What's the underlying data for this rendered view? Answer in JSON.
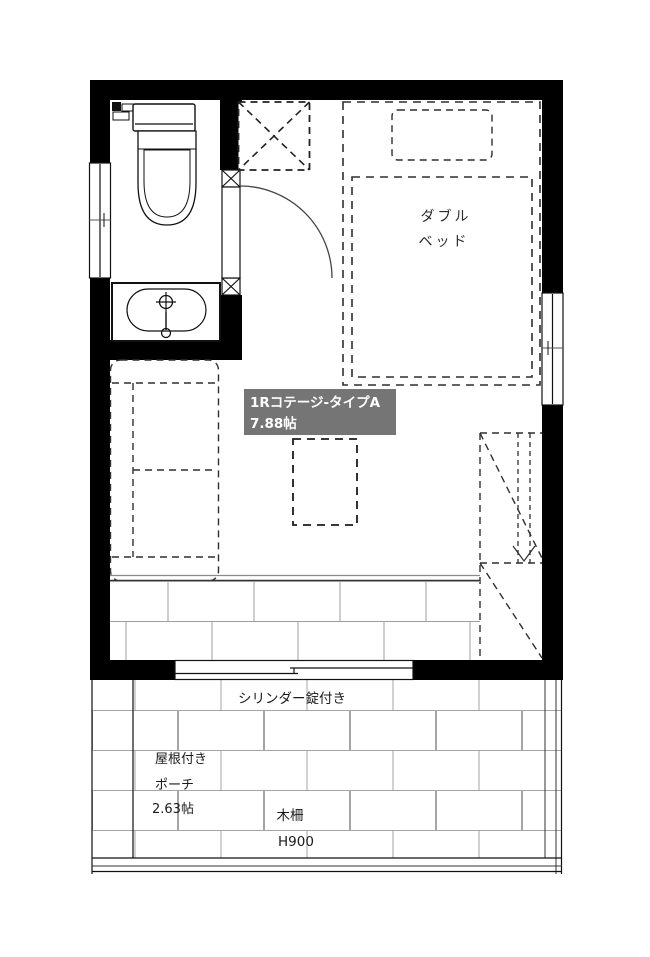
{
  "floor_plan": {
    "unit_label": {
      "name": "1Rコテージ-タイプA",
      "area": "7.88帖"
    },
    "bed_label": {
      "line1": "ダブル",
      "line2": "ベッド"
    },
    "door_note": "シリンダー錠付き",
    "porch_label": {
      "line1": "屋根付き",
      "line2": "ポーチ",
      "area": "2.63帖"
    },
    "fence_label": {
      "name": "木柵",
      "height": "H900"
    },
    "colors": {
      "wall": "#000000",
      "label_bg": "#757575",
      "label_text": "#ffffff",
      "dash_line": "#2f2f2f",
      "brick_joint": "#9e9e9e"
    }
  }
}
